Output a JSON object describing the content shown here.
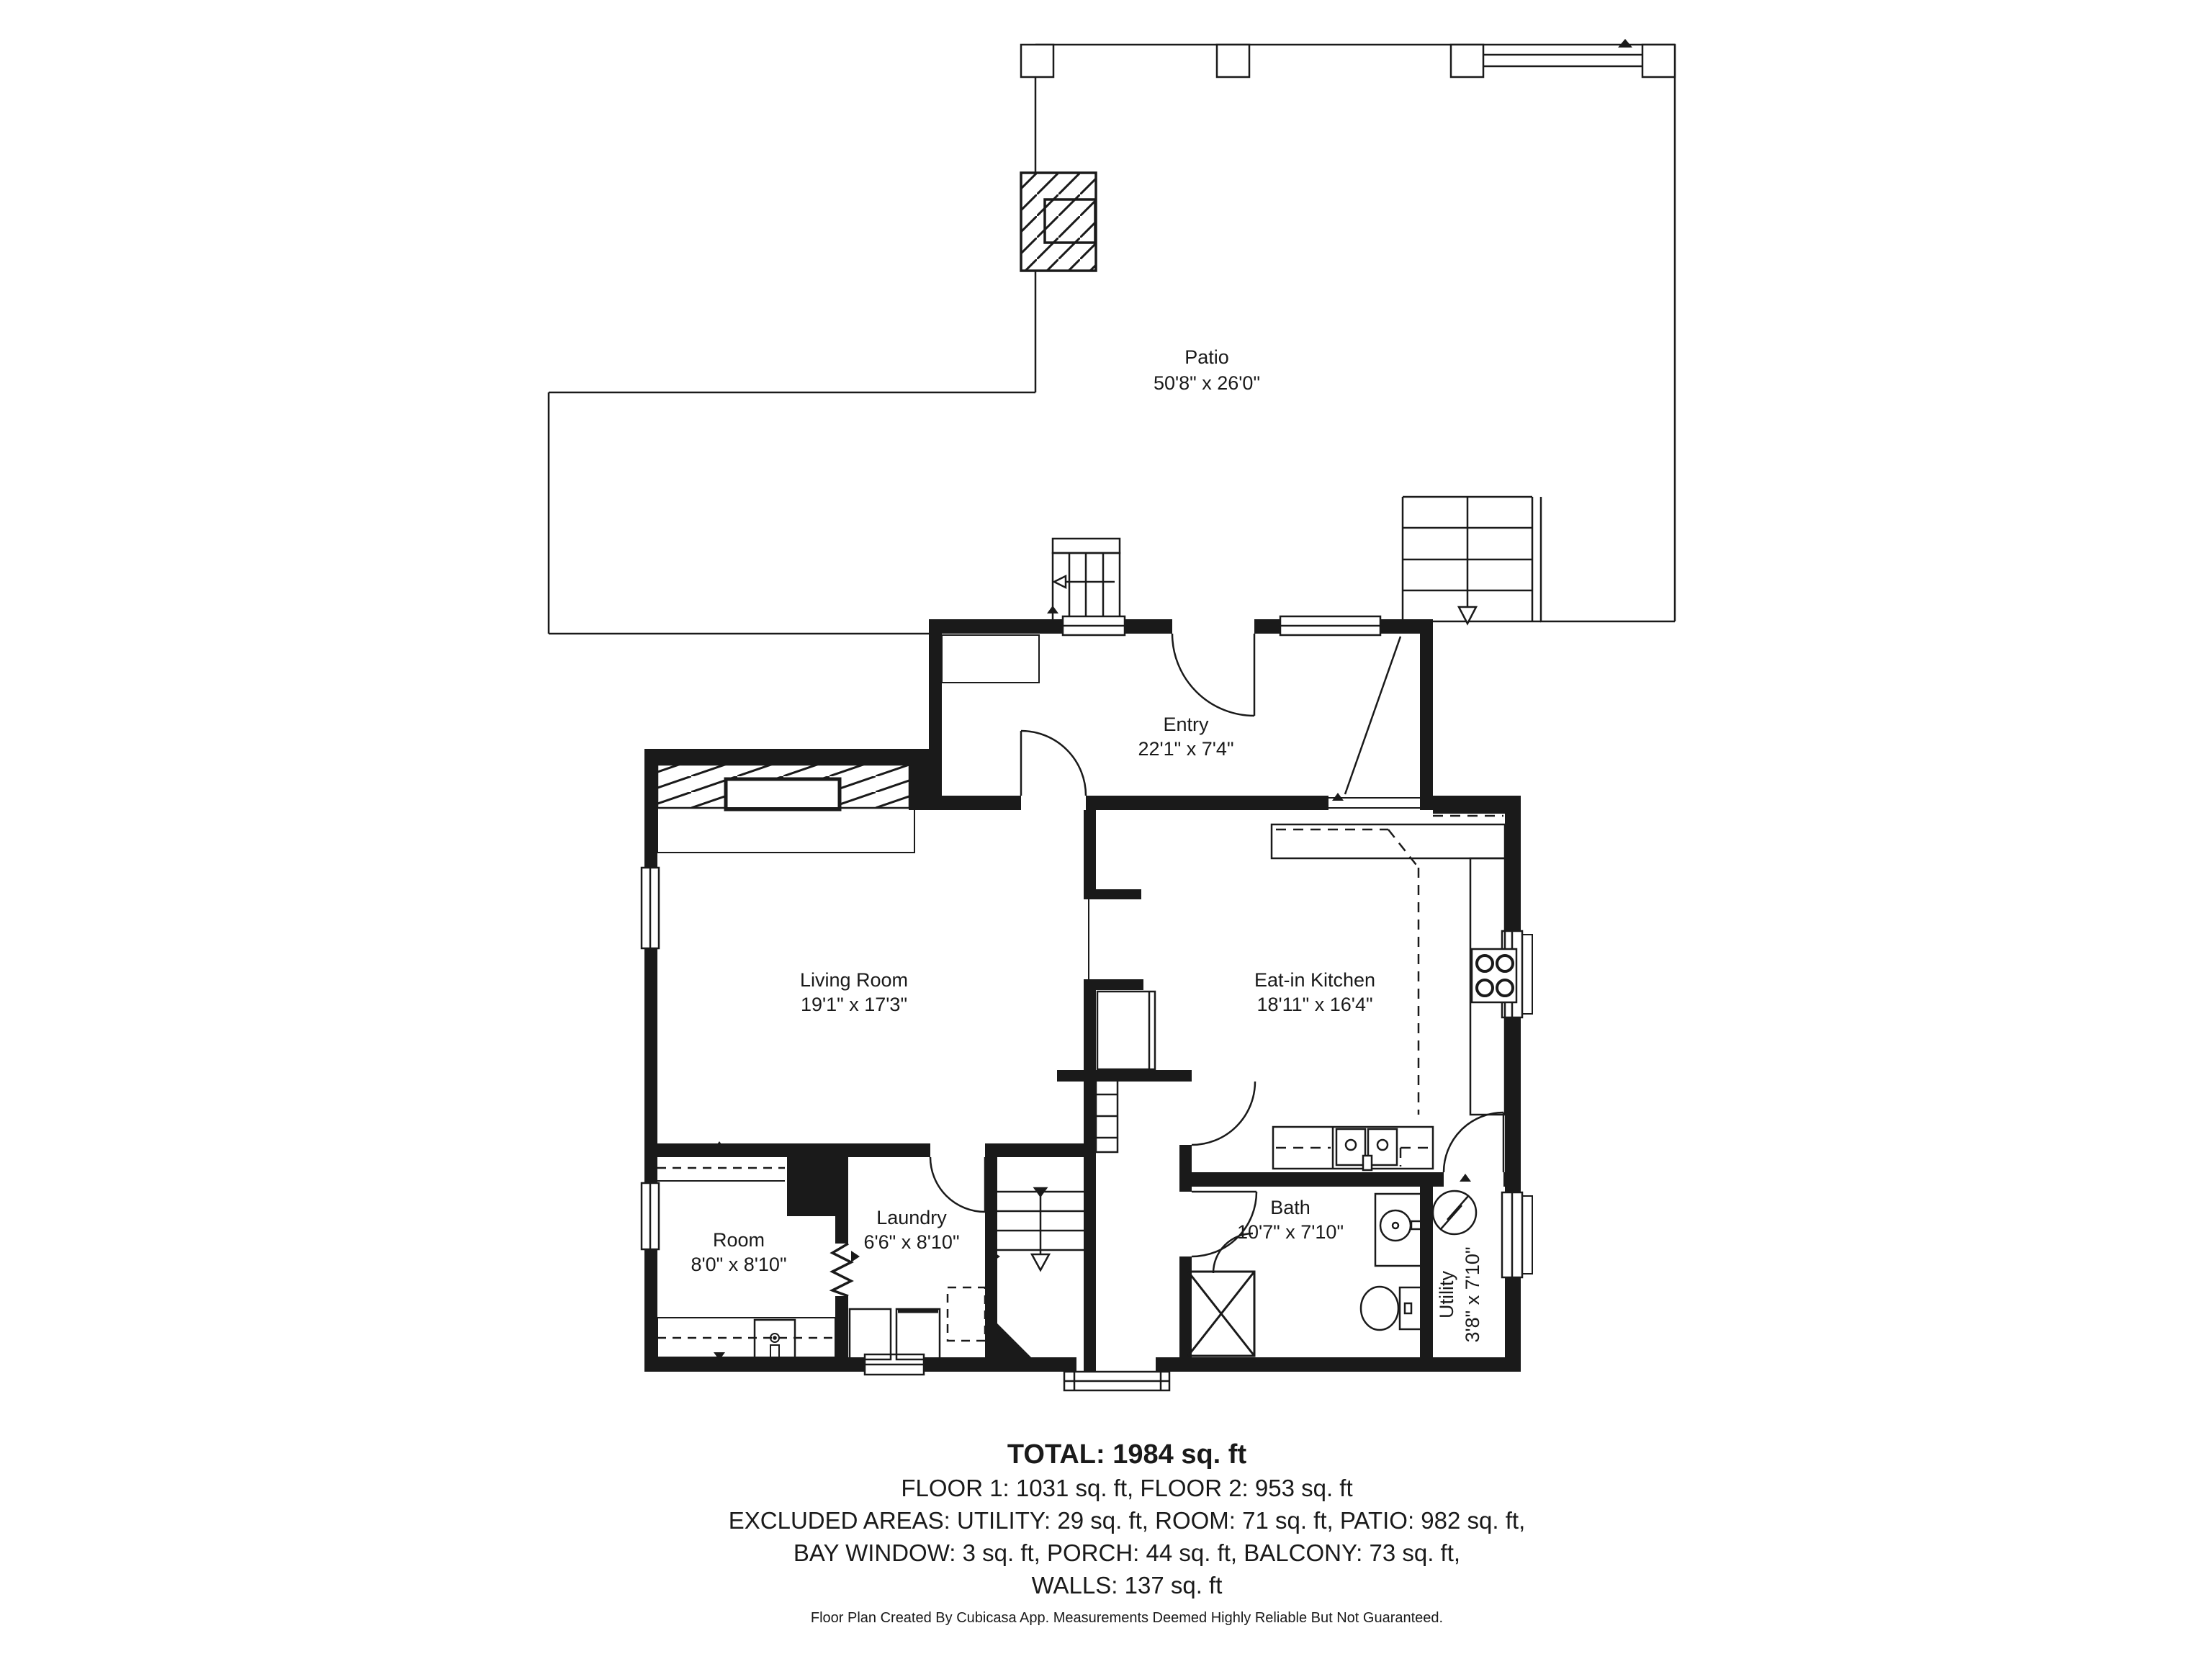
{
  "colors": {
    "ink": "#1a1a1a",
    "bg": "#ffffff"
  },
  "rooms": [
    {
      "name": "Patio",
      "dims": "50'8\" x 26'0\""
    },
    {
      "name": "Entry",
      "dims": "22'1\" x 7'4\""
    },
    {
      "name": "Living Room",
      "dims": "19'1\" x 17'3\""
    },
    {
      "name": "Eat-in Kitchen",
      "dims": "18'11\" x 16'4\""
    },
    {
      "name": "Room",
      "dims": "8'0\" x 8'10\""
    },
    {
      "name": "Laundry",
      "dims": "6'6\" x 8'10\""
    },
    {
      "name": "Bath",
      "dims": "10'7\" x 7'10\""
    },
    {
      "name": "Utility",
      "dims": "3'8\" x 7'10\""
    }
  ],
  "summary": {
    "total": "TOTAL: 1984 sq. ft",
    "floors": "FLOOR 1: 1031 sq. ft, FLOOR 2: 953 sq. ft",
    "excluded_line1": "EXCLUDED AREAS: UTILITY: 29 sq. ft, ROOM: 71 sq. ft, PATIO: 982 sq. ft,",
    "excluded_line2": "BAY WINDOW: 3 sq. ft, PORCH: 44 sq. ft, BALCONY: 73 sq. ft,",
    "walls": "WALLS: 137 sq. ft"
  },
  "footer": "Floor Plan Created By Cubicasa App. Measurements Deemed Highly Reliable But Not Guaranteed."
}
